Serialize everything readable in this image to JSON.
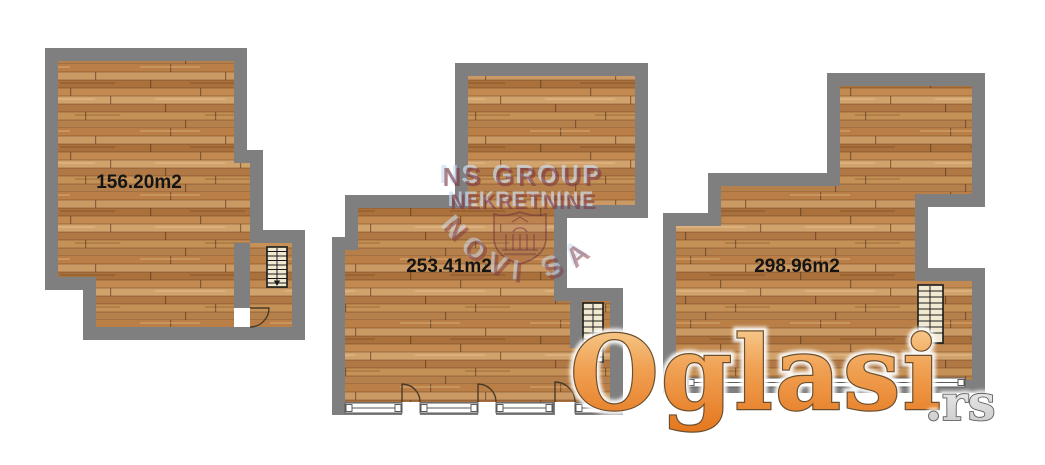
{
  "image_type": "real-estate floor plan photo",
  "units": [
    {
      "id": "unit-1",
      "area_label": "156.20m2"
    },
    {
      "id": "unit-2",
      "area_label": "253.41m2"
    },
    {
      "id": "unit-3",
      "area_label": "298.96m2"
    }
  ],
  "agency_watermark": {
    "line1": "NS GROUP",
    "line2": "NEKRETNINE",
    "city_arc": "NOVI SAD"
  },
  "site_watermark": {
    "brand": "Oglasi",
    "tld": ".rs"
  },
  "icons": {
    "staircase": "staircase-icon",
    "door_swing": "door-swing-icon",
    "window": "window-icon",
    "crest": "city-crest-icon"
  },
  "colors": {
    "background": "#ffffff",
    "wall_gray": "#7f7f7f",
    "wood_base": "#bf8a52",
    "stair_fill": "#f2e9d2",
    "watermark_maroon": "#7e3744",
    "watermark_shadow_blue": "#cbddf2",
    "brand_orange": "#ee8a2e",
    "label_text": "#141414"
  }
}
